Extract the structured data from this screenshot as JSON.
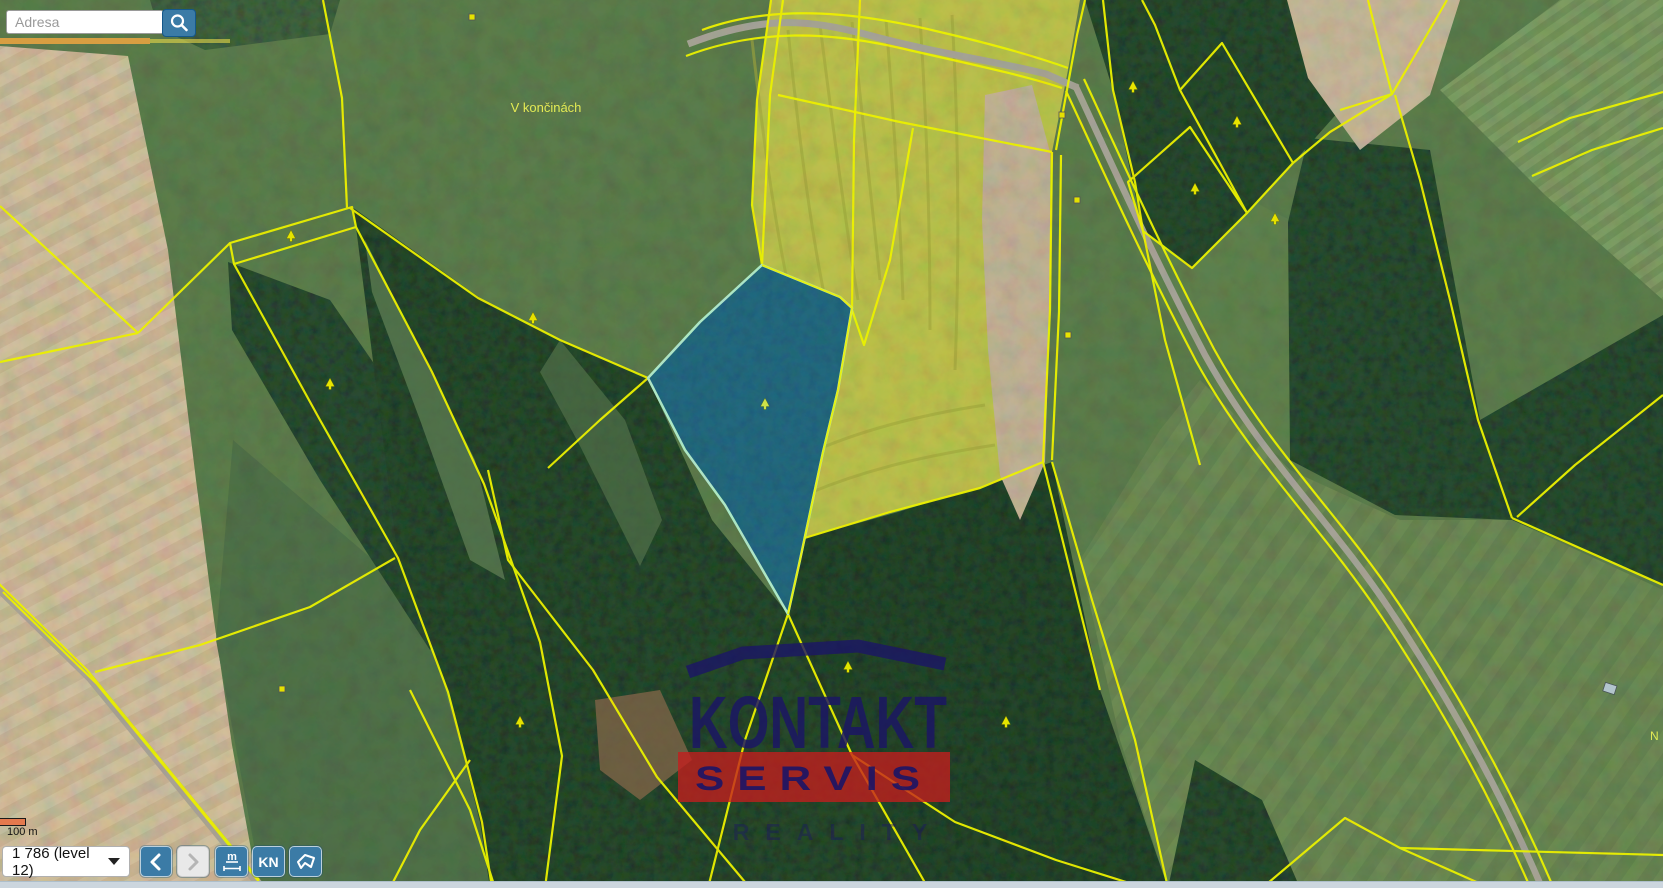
{
  "search": {
    "placeholder": "Adresa"
  },
  "map": {
    "place_label": "V končinách",
    "edge_label": "N",
    "boundary_color": "#eef200",
    "selected_parcel_color": "#2493e6",
    "selected_parcel_outline": "#aee8c8"
  },
  "scale": {
    "label": "100 m"
  },
  "toolbar": {
    "zoom_value": "1 786 (level 12)",
    "measure_label": "m",
    "kn_label": "KN"
  },
  "watermark": {
    "title": "KONTAKT",
    "band": "SERVIS",
    "subtitle": "REALITY",
    "navy": "#1b1566",
    "red": "#c41e1e"
  }
}
